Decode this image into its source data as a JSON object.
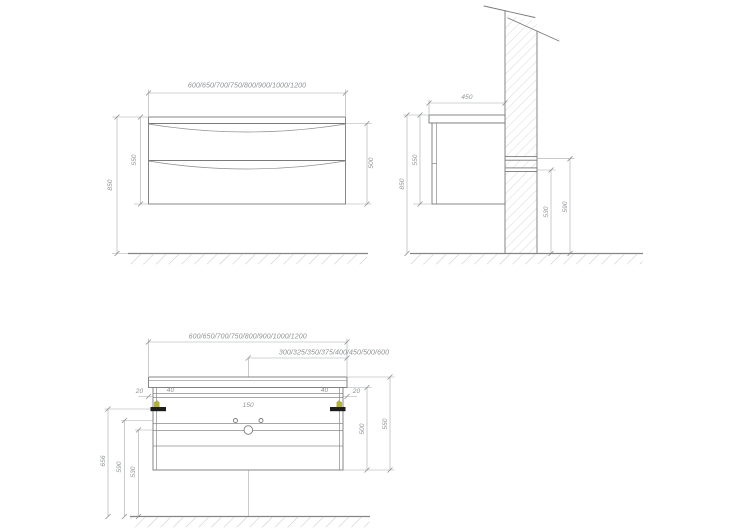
{
  "drawing": {
    "type": "furniture-technical-drawing",
    "subject": "wall-hung bathroom vanity cabinet with two drawers, three views",
    "units": "mm",
    "front": {
      "width_options": "600/650/700/750/800/900/1000/1200",
      "cabinet_height": "550",
      "top_height_from_floor": "850",
      "drawer_front_height": "500"
    },
    "side": {
      "depth": "450",
      "cabinet_height": "550",
      "top_height_from_floor": "850",
      "lower_rail_height": "530",
      "upper_rail_height": "590"
    },
    "back": {
      "width_options": "600/650/700/750/800/900/1000/1200",
      "center_to_edge_options": "300/325/350/375/400/450/500/600",
      "left_edge_offset": "20",
      "left_bracket_length": "40",
      "right_bracket_length": "40",
      "right_edge_offset": "20",
      "faucet_holes_spacing": "150",
      "bracket_height_from_floor": "656",
      "supply_holes_height_from_floor": "590",
      "drain_hole_height_from_floor": "530",
      "body_height": "500",
      "overall_height": "550"
    },
    "colors": {
      "line": "#7a7a7a",
      "dimension_line": "#a6a9ab",
      "label_text": "#8d9194",
      "hatch": "#c6c6c6",
      "bracket_yellow": "#b3b23a",
      "bracket_black": "#1d1d1d",
      "background": "#ffffff"
    }
  }
}
